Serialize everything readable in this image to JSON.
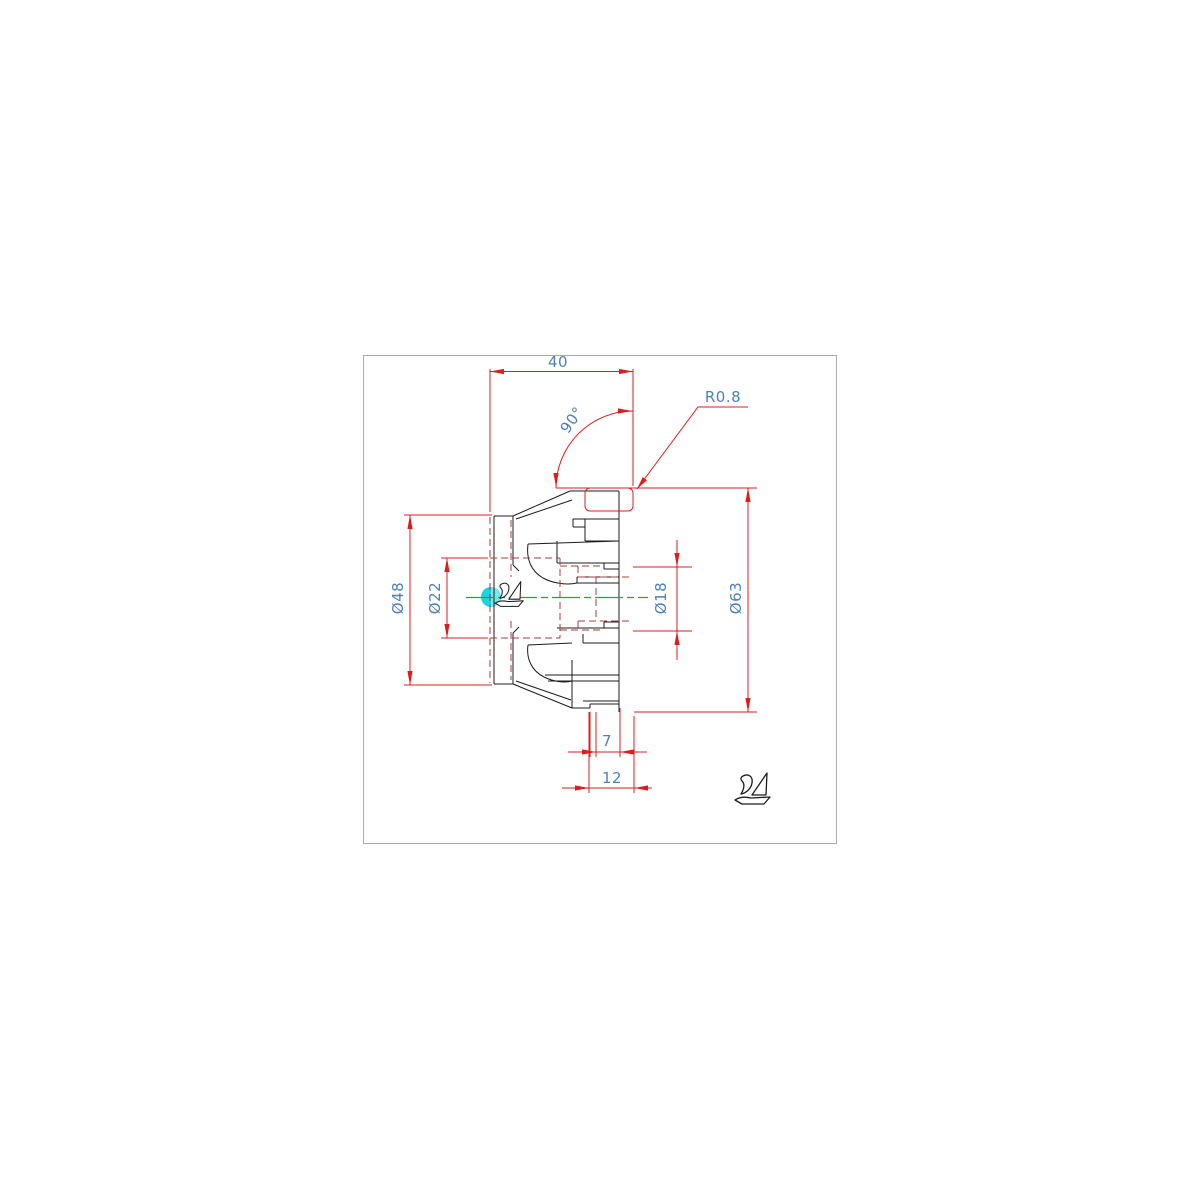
{
  "canvas": {
    "background": "#ffffff",
    "sheet_border": "#ababab"
  },
  "palette": {
    "outline": "#1c1c1c",
    "dimension_red": "#dd1c1c",
    "hidden_red": "#a63d3d",
    "label_blue": "#4d82b8",
    "centerline_green": "#00b340",
    "grip_cyan": "#1fd2dd"
  },
  "dimensions": {
    "overall_width": "40",
    "cone_angle": "90°",
    "corner_radius": "R0.8",
    "outer_diameter": "Ø63",
    "front_diameter": "Ø48",
    "counterbore_diameter": "Ø22",
    "bore_diameter": "Ø18",
    "spigot_length": "7",
    "hub_length": "12"
  },
  "markers": {
    "grip": "selection-grip",
    "cursor_stamp": "bird-glyph",
    "sheet_logo": "bird-glyph"
  }
}
